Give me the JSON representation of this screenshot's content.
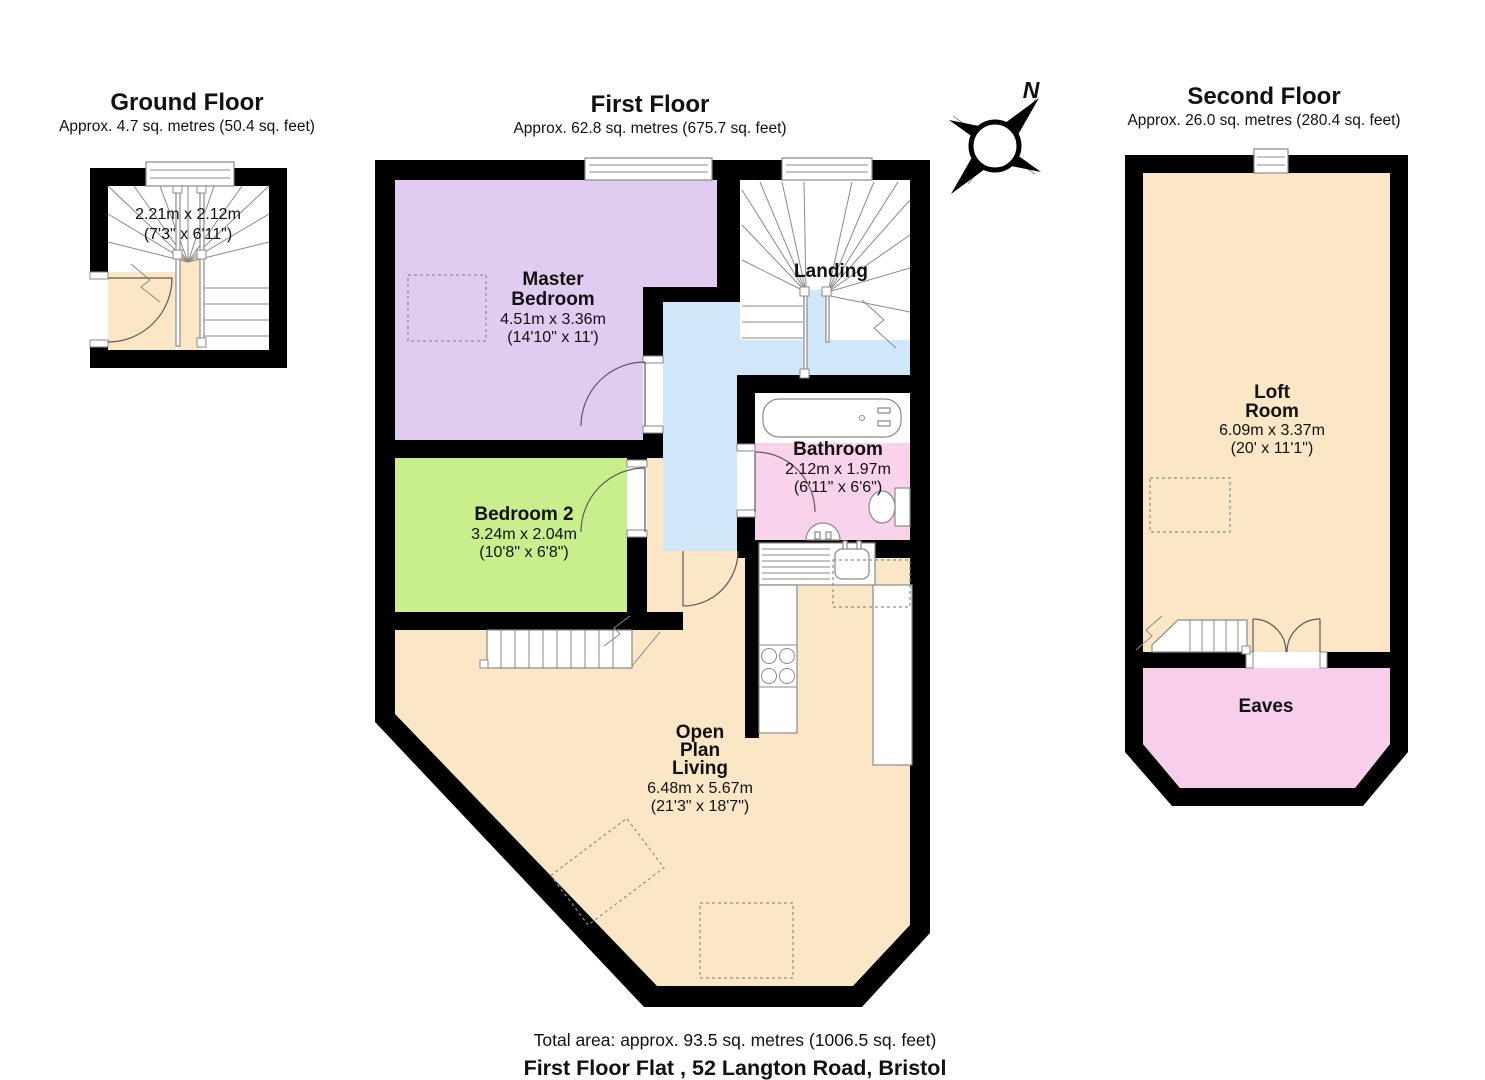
{
  "compass": {
    "north_label": "N"
  },
  "floors": {
    "ground": {
      "title": "Ground Floor",
      "area": "Approx. 4.7 sq. metres (50.4 sq. feet)",
      "stairwell": {
        "dims_m": "2.21m x 2.12m",
        "dims_ft": "(7'3\" x 6'11\")"
      }
    },
    "first": {
      "title": "First Floor",
      "area": "Approx. 62.8 sq. metres (675.7 sq. feet)",
      "rooms": {
        "master_bedroom": {
          "name_line1": "Master",
          "name_line2": "Bedroom",
          "dims_m": "4.51m x 3.36m",
          "dims_ft": "(14'10\" x 11')"
        },
        "landing": {
          "name": "Landing"
        },
        "bathroom": {
          "name": "Bathroom",
          "dims_m": "2.12m x 1.97m",
          "dims_ft": "(6'11\" x 6'6\")"
        },
        "bedroom2": {
          "name": "Bedroom 2",
          "dims_m": "3.24m x 2.04m",
          "dims_ft": "(10'8\" x 6'8\")"
        },
        "open_plan_living": {
          "name_line1": "Open",
          "name_line2": "Plan",
          "name_line3": "Living",
          "dims_m": "6.48m x 5.67m",
          "dims_ft": "(21'3\" x 18'7\")"
        }
      }
    },
    "second": {
      "title": "Second Floor",
      "area": "Approx. 26.0 sq. metres (280.4 sq. feet)",
      "rooms": {
        "loft_room": {
          "name_line1": "Loft",
          "name_line2": "Room",
          "dims_m": "6.09m x 3.37m",
          "dims_ft": "(20' x 11'1\")"
        },
        "eaves": {
          "name": "Eaves"
        }
      }
    }
  },
  "footer": {
    "total_area": "Total area: approx. 93.5 sq. metres (1006.5 sq. feet)",
    "address": "First Floor Flat , 52 Langton Road, Bristol"
  },
  "colors": {
    "wall": "#000000",
    "floor_cream": "#FBE7C6",
    "bedroom_purple": "#E2CBF1",
    "bedroom_green": "#C9EE8C",
    "hall_blue": "#CFE7F8",
    "bathroom_pink": "#F9D3EB",
    "eaves_pink": "#F7CFEC"
  }
}
